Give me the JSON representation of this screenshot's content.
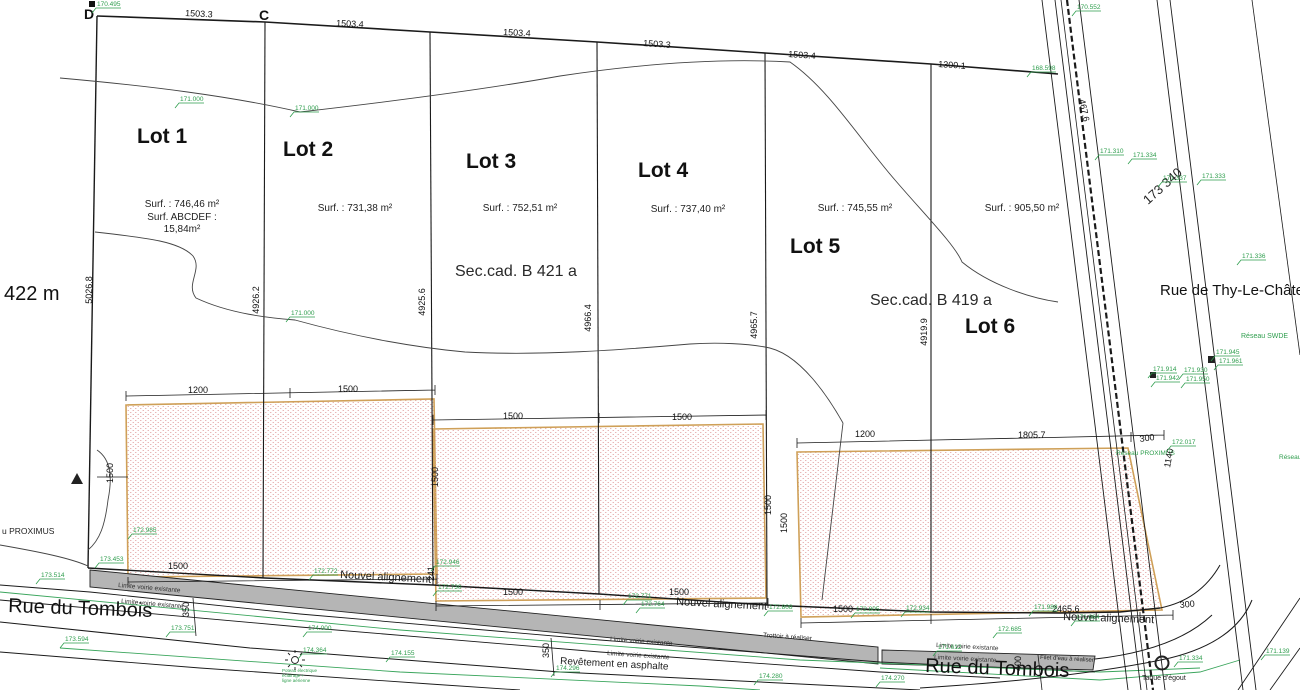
{
  "colors": {
    "line": "#1a1a1a",
    "green": "#2f9e4e",
    "zone_border": "#cfa058",
    "zone_hatch_dot": "#e09e9e",
    "sidewalk_grey": "#b5b5b5"
  },
  "corner_points": {
    "d": "D",
    "c": "C"
  },
  "labels": {
    "left_note": "422 m",
    "street_tombois": "Rue du Tombois",
    "street_tombois_2": "Rue du Tombois",
    "street_thy": "Rue de Thy-Le-Château",
    "sec_cad_1": "Sec.cad. B 421 a",
    "sec_cad_2": "Sec.cad. B 419 a",
    "road_station": "173 340",
    "reseau_swde": "Réseau SWDE",
    "reseau_proximus": "Réseau PROXIMUS",
    "reseau_proximus_left": "u PROXIMUS",
    "reseau_right": "Réseau",
    "taque": "Taque d'égout",
    "filet": "Filet d'eau à réaliser",
    "trottoir": "Trottoir à réaliser",
    "revetement": "Revêtement en asphalte",
    "pole_note_1": "Poteau électrique",
    "pole_note_2": "éclairage +",
    "pole_note_3": "ligne aérienne"
  },
  "lots": [
    {
      "name": "Lot 1",
      "surface": "Surf. : 746,46 m²",
      "extra1": "Surf. ABCDEF :",
      "extra2": "15,84m²"
    },
    {
      "name": "Lot 2",
      "surface": "Surf. : 731,38 m²"
    },
    {
      "name": "Lot 3",
      "surface": "Surf. : 752,51 m²"
    },
    {
      "name": "Lot 4",
      "surface": "Surf. : 737,40 m²"
    },
    {
      "name": "Lot 5",
      "surface": "Surf. : 745,55 m²"
    },
    {
      "name": "Lot 6",
      "surface": "Surf. : 905,50 m²"
    }
  ],
  "alignments": [
    {
      "label": "Nouvel alignement",
      "x": 340,
      "y": 578,
      "r": 3
    },
    {
      "label": "Nouvel alignement",
      "x": 676,
      "y": 605,
      "r": 3
    },
    {
      "label": "Nouvel alignement",
      "x": 1063,
      "y": 620,
      "r": 2
    }
  ],
  "limites": [
    {
      "label": "Limite voirie existante",
      "x": 118,
      "y": 587,
      "r": 5
    },
    {
      "label": "Limite voirie existante",
      "x": 121,
      "y": 603,
      "r": 5
    },
    {
      "label": "Limite voirie existante",
      "x": 610,
      "y": 641,
      "r": 4
    },
    {
      "label": "Limite voirie existante",
      "x": 607,
      "y": 655,
      "r": 4
    },
    {
      "label": "Limite voirie existante",
      "x": 936,
      "y": 647,
      "r": 3
    },
    {
      "label": "Limite voirie existante",
      "x": 934,
      "y": 659,
      "r": 3
    }
  ],
  "top_dims": [
    {
      "t": "1503.3",
      "x": 185,
      "y": 16,
      "r": 3
    },
    {
      "t": "1503.4",
      "x": 336,
      "y": 26,
      "r": 3
    },
    {
      "t": "1503.4",
      "x": 503,
      "y": 35,
      "r": 3
    },
    {
      "t": "1503.3",
      "x": 643,
      "y": 46,
      "r": 4
    },
    {
      "t": "1503.4",
      "x": 788,
      "y": 57,
      "r": 4
    },
    {
      "t": "1300.1",
      "x": 938,
      "y": 67,
      "r": 4
    }
  ],
  "depth_dims": [
    {
      "t": "5026.8",
      "x": 92,
      "y": 290
    },
    {
      "t": "4926.2",
      "x": 259,
      "y": 300
    },
    {
      "t": "4925.6",
      "x": 425,
      "y": 302
    },
    {
      "t": "4966.4",
      "x": 591,
      "y": 318
    },
    {
      "t": "4965.7",
      "x": 757,
      "y": 325
    },
    {
      "t": "4919.9",
      "x": 927,
      "y": 332
    }
  ],
  "zone_dims": [
    {
      "t": "1200",
      "x": 188,
      "y": 393,
      "r": 0
    },
    {
      "t": "1500",
      "x": 338,
      "y": 392,
      "r": 0
    },
    {
      "t": "1500",
      "x": 503,
      "y": 419,
      "r": 0
    },
    {
      "t": "1500",
      "x": 672,
      "y": 420,
      "r": 0
    },
    {
      "t": "1200",
      "x": 855,
      "y": 437,
      "r": 0
    },
    {
      "t": "1805.7",
      "x": 1018,
      "y": 438,
      "r": 0
    },
    {
      "t": "300",
      "x": 1140,
      "y": 442,
      "r": -8
    },
    {
      "t": "1500",
      "x": 168,
      "y": 569,
      "r": 0
    },
    {
      "t": "1500",
      "x": 503,
      "y": 595,
      "r": 0
    },
    {
      "t": "1500",
      "x": 669,
      "y": 595,
      "r": 0
    },
    {
      "t": "1500",
      "x": 833,
      "y": 612,
      "r": 0
    },
    {
      "t": "2465.6",
      "x": 1052,
      "y": 612,
      "r": 0
    },
    {
      "t": "300",
      "x": 1180,
      "y": 608,
      "r": -6
    },
    {
      "t": "1500",
      "x": 113,
      "y": 483,
      "r": -90
    },
    {
      "t": "1500",
      "x": 438,
      "y": 487,
      "r": -90
    },
    {
      "t": "1500",
      "x": 771,
      "y": 515,
      "r": -90
    },
    {
      "t": "1500",
      "x": 787,
      "y": 533,
      "r": -90
    },
    {
      "t": "350",
      "x": 189,
      "y": 617,
      "r": -90
    },
    {
      "t": "350",
      "x": 549,
      "y": 658,
      "r": -90
    },
    {
      "t": "400",
      "x": 1021,
      "y": 671,
      "r": -90
    },
    {
      "t": "241",
      "x": 434,
      "y": 581,
      "r": -90
    },
    {
      "t": "1140",
      "x": 1170,
      "y": 468,
      "r": -80
    },
    {
      "t": "467.6",
      "x": 1079,
      "y": 100,
      "r": 78
    }
  ],
  "elevations": [
    {
      "v": "170.495",
      "x": 97,
      "y": 6
    },
    {
      "v": "171.000",
      "x": 180,
      "y": 101
    },
    {
      "v": "171.000",
      "x": 295,
      "y": 110
    },
    {
      "v": "171.000",
      "x": 291,
      "y": 315
    },
    {
      "v": "170.552",
      "x": 1077,
      "y": 9
    },
    {
      "v": "168.598",
      "x": 1032,
      "y": 70
    },
    {
      "v": "171.310",
      "x": 1100,
      "y": 153
    },
    {
      "v": "171.334",
      "x": 1133,
      "y": 157
    },
    {
      "v": "171.337",
      "x": 1163,
      "y": 180
    },
    {
      "v": "171.333",
      "x": 1202,
      "y": 178
    },
    {
      "v": "171.336",
      "x": 1242,
      "y": 258
    },
    {
      "v": "171.945",
      "x": 1216,
      "y": 354
    },
    {
      "v": "171.961",
      "x": 1219,
      "y": 363
    },
    {
      "v": "171.914",
      "x": 1153,
      "y": 371
    },
    {
      "v": "171.942",
      "x": 1156,
      "y": 380
    },
    {
      "v": "171.930",
      "x": 1184,
      "y": 372
    },
    {
      "v": "171.950",
      "x": 1186,
      "y": 381
    },
    {
      "v": "172.017",
      "x": 1172,
      "y": 444
    },
    {
      "v": "172.985",
      "x": 133,
      "y": 532
    },
    {
      "v": "173.453",
      "x": 100,
      "y": 561
    },
    {
      "v": "173.514",
      "x": 41,
      "y": 577
    },
    {
      "v": "173.594",
      "x": 65,
      "y": 641
    },
    {
      "v": "173.751",
      "x": 171,
      "y": 630
    },
    {
      "v": "174.364",
      "x": 303,
      "y": 652
    },
    {
      "v": "174.000",
      "x": 308,
      "y": 630
    },
    {
      "v": "174.155",
      "x": 391,
      "y": 655
    },
    {
      "v": "172.772",
      "x": 314,
      "y": 573
    },
    {
      "v": "172.946",
      "x": 436,
      "y": 564
    },
    {
      "v": "172.730",
      "x": 438,
      "y": 589
    },
    {
      "v": "172.771",
      "x": 628,
      "y": 598
    },
    {
      "v": "172.764",
      "x": 641,
      "y": 606
    },
    {
      "v": "172.808",
      "x": 769,
      "y": 609
    },
    {
      "v": "172.805",
      "x": 856,
      "y": 611
    },
    {
      "v": "172.934",
      "x": 906,
      "y": 610
    },
    {
      "v": "171.988",
      "x": 1034,
      "y": 609
    },
    {
      "v": "171.064",
      "x": 1076,
      "y": 619
    },
    {
      "v": "172.685",
      "x": 998,
      "y": 631
    },
    {
      "v": "171.612",
      "x": 938,
      "y": 649
    },
    {
      "v": "171.334",
      "x": 1179,
      "y": 660
    },
    {
      "v": "174.296",
      "x": 556,
      "y": 670
    },
    {
      "v": "174.280",
      "x": 759,
      "y": 678
    },
    {
      "v": "174.270",
      "x": 881,
      "y": 680
    },
    {
      "v": "171.139",
      "x": 1266,
      "y": 653
    }
  ]
}
